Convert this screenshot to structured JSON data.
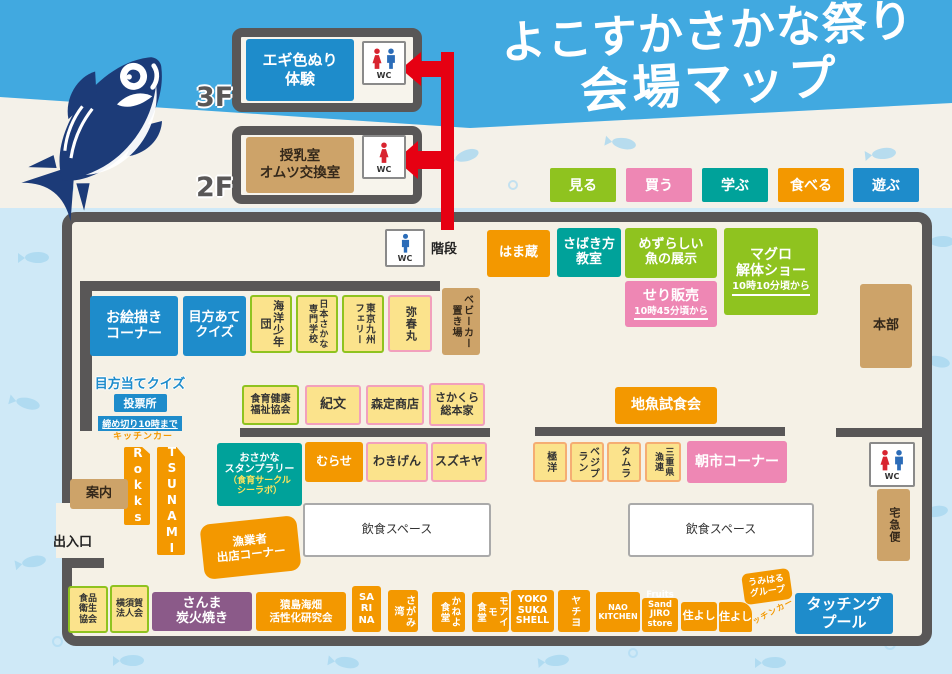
{
  "title": {
    "line1": "よこすかさかな祭り",
    "line2": "会場マップ"
  },
  "legend": {
    "items": [
      {
        "label": "見る",
        "color": "#8FC31F"
      },
      {
        "label": "買う",
        "color": "#EE87B4"
      },
      {
        "label": "学ぶ",
        "color": "#00A29A"
      },
      {
        "label": "食べる",
        "color": "#F39800"
      },
      {
        "label": "遊ぶ",
        "color": "#1E8CCB"
      }
    ]
  },
  "floors": {
    "f3": {
      "label": "3F",
      "room": "エギ色ぬり\n体験",
      "wc": "WC"
    },
    "f2": {
      "label": "2F",
      "room": "授乳室\nオムツ交換室",
      "wc": "WC"
    }
  },
  "palette": {
    "band_blue": "#41A9E0",
    "page_bg": "#CFE9F7",
    "map_bg": "#F5F1E6",
    "wall_gray": "#595757",
    "orange": "#F39800",
    "teal": "#00A29A",
    "green": "#8FC31F",
    "pink": "#EE87B4",
    "blue": "#1E8CCB",
    "yellow": "#FBE38C",
    "tan": "#CDA369",
    "purple": "#8B5A89",
    "arrow_red": "#E60012",
    "wc_male_blue": "#2B6CB8",
    "wc_female_red": "#D8242F"
  },
  "map": {
    "booths": {
      "wcTop": "WC",
      "stairs": "階段",
      "hamakura": "はま蔵",
      "sabaki": "さばき方\n教室",
      "mezurashii": "めずらしい\n魚の展示",
      "seri": "せり販売",
      "seriTime": "10時45分頃から",
      "maguro": "マグロ\n解体ショー",
      "maguroTime": "10時10分頃から",
      "honbu": "本部",
      "oekaki": "お絵描き\nコーナー",
      "mekataQuiz": "目方あて\nクイズ",
      "kaiyo": "海洋少年団",
      "fishSchool": "日本さかな\n専門学校",
      "ferry": "東京九州\nフェリー",
      "yaharumaru": "弥春丸",
      "stroller": "ベビーカー\n置き場",
      "voteTitle": "目方当てクイズ",
      "voteSub": "投票所",
      "voteNote": "締め切り10時まで",
      "shokuiku": "食育健康\n福祉協会",
      "kibun": "紀文",
      "morisada": "森定商店",
      "sakakura": "さかくら\n総本家",
      "jizakana": "地魚試食会",
      "stampMain": "おさかな\nスタンプラリー",
      "stampSub": "（食育サークル\nシーラボ）",
      "murase": "むらせ",
      "wakigen": "わきげん",
      "suzukiya": "スズキヤ",
      "kyokuyo": "極洋",
      "vegiplan": "ベジプラン",
      "tamura": "タムラ",
      "mie": "三重県\n漁連",
      "asaichi": "朝市コーナー",
      "wcRight": "WC",
      "takkyubin": "宅急便",
      "kitchenCarLeft": "キッチンカー",
      "rokks": "Rokks",
      "tsunami": "TSUNAMI",
      "annai": "案内",
      "exit": "出入口",
      "gyogyosha": "漁業者\n出店コーナー",
      "diningLeft": "飲食スペース",
      "diningRight": "飲食スペース",
      "shokuhin": "食品\n衛生\n協会",
      "hojinkai": "横須賀\n法人会",
      "sanma": "さんま\n炭火焼き",
      "sarushima": "猿島海畑\n活性化研究会",
      "sarina": "SA\nRI\nNA",
      "sagamiwan": "さがみ湾",
      "kaneyo": "かねよ\n食堂",
      "moaimo": "モアイモ\n食堂",
      "shell": "YOKO\nSUKA\nSHELL",
      "yachiyo": "ヤチヨ",
      "naoKitchen": "NAO\nKITCHEN",
      "fruits": "Fruits\nSand\nJIRO\nstore",
      "sumiyoshi1": "住よし",
      "sumiyoshi2": "住よし",
      "umiharu": "うみはる\nグループ",
      "kitchenCarRight": "キッチンカー",
      "pool": "タッチング\nプール"
    }
  }
}
